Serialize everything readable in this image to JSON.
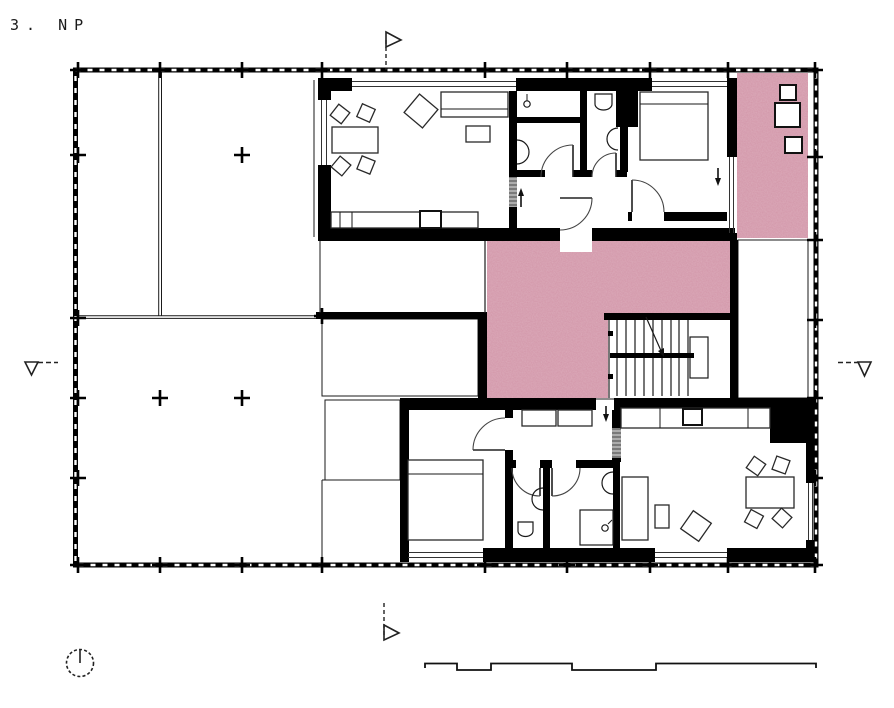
{
  "title": "3. NP",
  "colors": {
    "wall": "#000000",
    "line": "#1a1a1a",
    "pink_fill": "#d295a8",
    "hatch_line": "#b8537a",
    "paper": "#ffffff"
  },
  "symbols": {
    "north_indicator": "circle-with-meridian-line",
    "section_marker_top": "right-pointing-flag",
    "section_marker_bottom": "right-pointing-flag",
    "section_marker_left": "down-triangle-with-dash",
    "section_marker_right": "down-triangle-with-dash",
    "column_marker": "plus-cross",
    "entry_arrow_unit_a": "up",
    "entry_arrow_unit_b": "down",
    "terrace_door_arrow": "down"
  },
  "areas": {
    "solid_fill_areas": [
      "stair-landing",
      "roof-terrace-top-right"
    ],
    "crosshatch_areas": [
      "void-left-upper",
      "void-left-lower",
      "void-right"
    ]
  }
}
